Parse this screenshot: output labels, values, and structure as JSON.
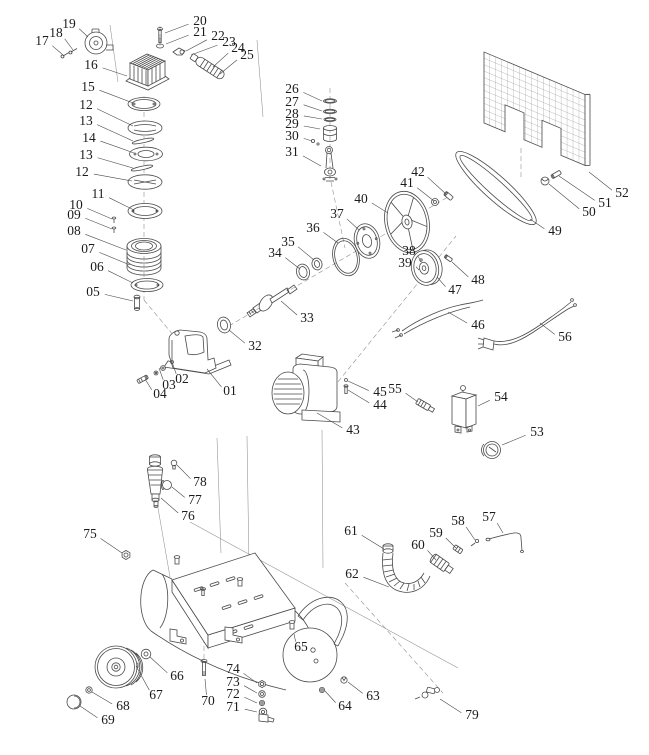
{
  "diagram": {
    "type": "exploded-parts-diagram",
    "subject": "belt-driven air compressor",
    "background": "#ffffff",
    "line_color": "#4a4a4a",
    "label_color": "#1b1b1b",
    "label_font_size": 13.5,
    "labels": [
      {
        "n": "19",
        "x": 69,
        "y": 25,
        "px": 88,
        "py": 37
      },
      {
        "n": "18",
        "x": 56,
        "y": 34,
        "px": 73,
        "py": 50
      },
      {
        "n": "17",
        "x": 42,
        "y": 42,
        "px": 63,
        "py": 55
      },
      {
        "n": "16",
        "x": 91,
        "y": 66,
        "px": 127,
        "py": 76
      },
      {
        "n": "15",
        "x": 88,
        "y": 88,
        "px": 133,
        "py": 103
      },
      {
        "n": "12",
        "x": 86,
        "y": 106,
        "px": 133,
        "py": 126
      },
      {
        "n": "13",
        "x": 86,
        "y": 122,
        "px": 133,
        "py": 141
      },
      {
        "n": "14",
        "x": 89,
        "y": 139,
        "px": 134,
        "py": 153
      },
      {
        "n": "13",
        "x": 86,
        "y": 156,
        "px": 133,
        "py": 168
      },
      {
        "n": "12",
        "x": 82,
        "y": 173,
        "px": 132,
        "py": 181
      },
      {
        "n": "11",
        "x": 98,
        "y": 195,
        "px": 134,
        "py": 210
      },
      {
        "n": "10",
        "x": 76,
        "y": 206,
        "px": 112,
        "py": 219
      },
      {
        "n": "09",
        "x": 74,
        "y": 216,
        "px": 112,
        "py": 229
      },
      {
        "n": "08",
        "x": 74,
        "y": 232,
        "px": 126,
        "py": 250
      },
      {
        "n": "07",
        "x": 88,
        "y": 250,
        "px": 130,
        "py": 265
      },
      {
        "n": "06",
        "x": 97,
        "y": 268,
        "px": 133,
        "py": 283
      },
      {
        "n": "05",
        "x": 93,
        "y": 293,
        "px": 133,
        "py": 301
      },
      {
        "n": "20",
        "x": 200,
        "y": 22,
        "px": 165,
        "py": 33
      },
      {
        "n": "21",
        "x": 200,
        "y": 33,
        "px": 166,
        "py": 44
      },
      {
        "n": "22",
        "x": 218,
        "y": 37,
        "px": 186,
        "py": 51
      },
      {
        "n": "23",
        "x": 229,
        "y": 43,
        "px": 191,
        "py": 55
      },
      {
        "n": "24",
        "x": 238,
        "y": 49,
        "px": 213,
        "py": 67
      },
      {
        "n": "25",
        "x": 247,
        "y": 56,
        "px": 220,
        "py": 74
      },
      {
        "n": "26",
        "x": 292,
        "y": 90,
        "px": 322,
        "py": 101
      },
      {
        "n": "27",
        "x": 292,
        "y": 103,
        "px": 322,
        "py": 111
      },
      {
        "n": "28",
        "x": 292,
        "y": 115,
        "px": 322,
        "py": 119
      },
      {
        "n": "29",
        "x": 292,
        "y": 125,
        "px": 320,
        "py": 129
      },
      {
        "n": "30",
        "x": 292,
        "y": 137,
        "px": 312,
        "py": 141
      },
      {
        "n": "31",
        "x": 292,
        "y": 153,
        "px": 321,
        "py": 166
      },
      {
        "n": "42",
        "x": 418,
        "y": 173,
        "px": 446,
        "py": 194
      },
      {
        "n": "41",
        "x": 407,
        "y": 184,
        "px": 434,
        "py": 201
      },
      {
        "n": "40",
        "x": 361,
        "y": 200,
        "px": 388,
        "py": 213
      },
      {
        "n": "37",
        "x": 337,
        "y": 215,
        "px": 359,
        "py": 230
      },
      {
        "n": "36",
        "x": 313,
        "y": 229,
        "px": 338,
        "py": 243
      },
      {
        "n": "35",
        "x": 288,
        "y": 243,
        "px": 314,
        "py": 260
      },
      {
        "n": "34",
        "x": 275,
        "y": 254,
        "px": 300,
        "py": 269
      },
      {
        "n": "38",
        "x": 409,
        "y": 252,
        "px": 421,
        "py": 262
      },
      {
        "n": "39",
        "x": 405,
        "y": 264,
        "px": 419,
        "py": 270
      },
      {
        "n": "48",
        "x": 478,
        "y": 281,
        "px": 452,
        "py": 262
      },
      {
        "n": "47",
        "x": 455,
        "y": 291,
        "px": 437,
        "py": 277
      },
      {
        "n": "33",
        "x": 307,
        "y": 319,
        "px": 281,
        "py": 301
      },
      {
        "n": "32",
        "x": 255,
        "y": 347,
        "px": 229,
        "py": 330
      },
      {
        "n": "49",
        "x": 555,
        "y": 232,
        "px": 530,
        "py": 219
      },
      {
        "n": "50",
        "x": 589,
        "y": 213,
        "px": 549,
        "py": 184
      },
      {
        "n": "51",
        "x": 605,
        "y": 204,
        "px": 559,
        "py": 176
      },
      {
        "n": "52",
        "x": 622,
        "y": 194,
        "px": 589,
        "py": 172
      },
      {
        "n": "46",
        "x": 478,
        "y": 326,
        "px": 448,
        "py": 312
      },
      {
        "n": "56",
        "x": 565,
        "y": 338,
        "px": 540,
        "py": 323
      },
      {
        "n": "02",
        "x": 182,
        "y": 380,
        "px": 172,
        "py": 362
      },
      {
        "n": "03",
        "x": 169,
        "y": 386,
        "px": 159,
        "py": 368
      },
      {
        "n": "04",
        "x": 160,
        "y": 395,
        "px": 145,
        "py": 379
      },
      {
        "n": "01",
        "x": 230,
        "y": 392,
        "px": 207,
        "py": 369
      },
      {
        "n": "45",
        "x": 380,
        "y": 393,
        "px": 348,
        "py": 381
      },
      {
        "n": "55",
        "x": 395,
        "y": 390,
        "px": 418,
        "py": 402
      },
      {
        "n": "44",
        "x": 380,
        "y": 406,
        "px": 348,
        "py": 390
      },
      {
        "n": "54",
        "x": 501,
        "y": 398,
        "px": 478,
        "py": 406
      },
      {
        "n": "43",
        "x": 353,
        "y": 431,
        "px": 317,
        "py": 413
      },
      {
        "n": "53",
        "x": 537,
        "y": 433,
        "px": 502,
        "py": 445
      },
      {
        "n": "78",
        "x": 200,
        "y": 483,
        "px": 177,
        "py": 465
      },
      {
        "n": "77",
        "x": 195,
        "y": 501,
        "px": 172,
        "py": 487
      },
      {
        "n": "76",
        "x": 188,
        "y": 517,
        "px": 161,
        "py": 498
      },
      {
        "n": "75",
        "x": 90,
        "y": 535,
        "px": 122,
        "py": 553
      },
      {
        "n": "61",
        "x": 351,
        "y": 532,
        "px": 384,
        "py": 549
      },
      {
        "n": "59",
        "x": 436,
        "y": 534,
        "px": 456,
        "py": 548
      },
      {
        "n": "60",
        "x": 418,
        "y": 546,
        "px": 436,
        "py": 560
      },
      {
        "n": "58",
        "x": 458,
        "y": 522,
        "px": 475,
        "py": 540
      },
      {
        "n": "57",
        "x": 489,
        "y": 518,
        "px": 503,
        "py": 533
      },
      {
        "n": "62",
        "x": 352,
        "y": 575,
        "px": 389,
        "py": 587
      },
      {
        "n": "65",
        "x": 301,
        "y": 648,
        "px": 294,
        "py": 634
      },
      {
        "n": "66",
        "x": 177,
        "y": 677,
        "px": 150,
        "py": 657
      },
      {
        "n": "67",
        "x": 156,
        "y": 696,
        "px": 136,
        "py": 666
      },
      {
        "n": "68",
        "x": 123,
        "y": 707,
        "px": 92,
        "py": 692
      },
      {
        "n": "69",
        "x": 108,
        "y": 721,
        "px": 80,
        "py": 706
      },
      {
        "n": "74",
        "x": 233,
        "y": 670,
        "px": 257,
        "py": 683
      },
      {
        "n": "73",
        "x": 233,
        "y": 683,
        "px": 257,
        "py": 693
      },
      {
        "n": "72",
        "x": 233,
        "y": 695,
        "px": 257,
        "py": 703
      },
      {
        "n": "71",
        "x": 233,
        "y": 708,
        "px": 257,
        "py": 712
      },
      {
        "n": "70",
        "x": 208,
        "y": 702,
        "px": 205,
        "py": 679
      },
      {
        "n": "64",
        "x": 345,
        "y": 707,
        "px": 325,
        "py": 691
      },
      {
        "n": "63",
        "x": 373,
        "y": 697,
        "px": 348,
        "py": 682
      },
      {
        "n": "79",
        "x": 472,
        "y": 716,
        "px": 440,
        "py": 699
      }
    ]
  }
}
